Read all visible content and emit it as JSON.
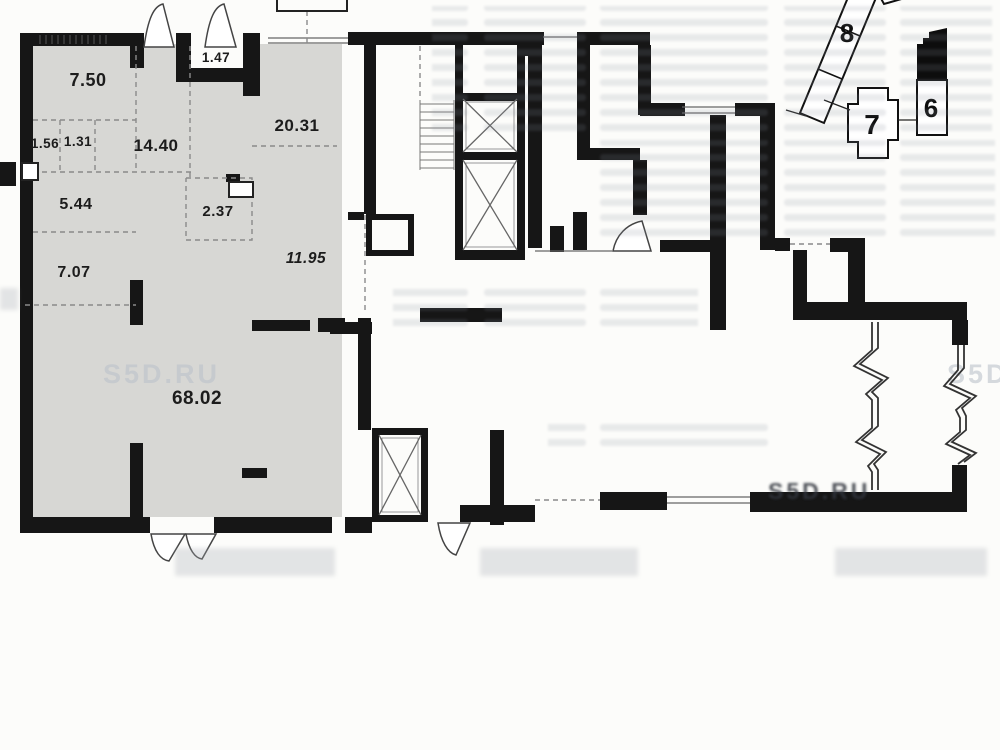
{
  "plan": {
    "rooms": [
      {
        "area": "7.50"
      },
      {
        "area": "1.47"
      },
      {
        "area": "20.31"
      },
      {
        "area": "14.40"
      },
      {
        "area": "1.56"
      },
      {
        "area": "1.31"
      },
      {
        "area": "5.44"
      },
      {
        "area": "2.37"
      },
      {
        "area": "7.07"
      },
      {
        "area": "11.95"
      },
      {
        "area": "68.02"
      }
    ],
    "site_key": {
      "buildings": [
        {
          "label": "8"
        },
        {
          "label": "7"
        },
        {
          "label": "6"
        }
      ]
    },
    "watermark": "S5D.RU",
    "colors": {
      "wall": "#161616",
      "unit_fill": "#d7d7d4",
      "paper": "#fcfcfa"
    }
  }
}
